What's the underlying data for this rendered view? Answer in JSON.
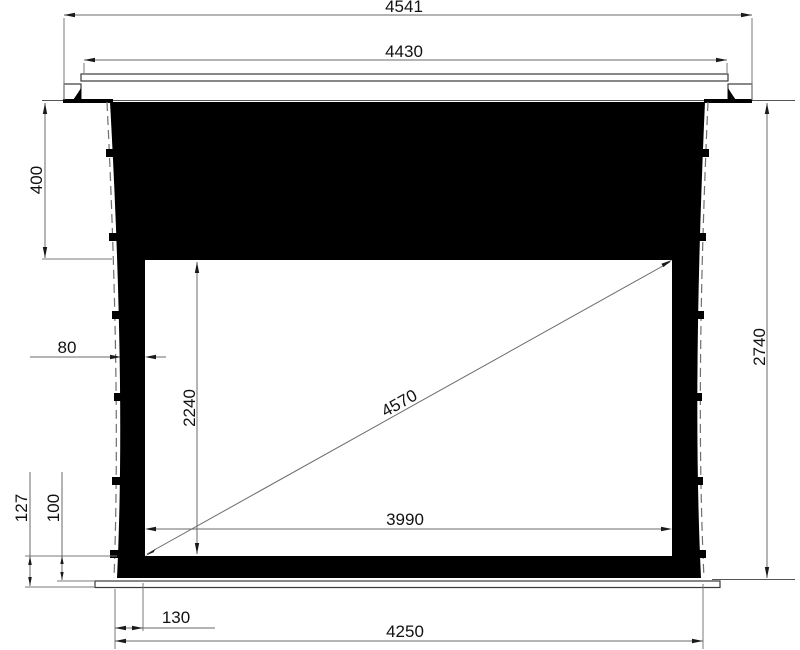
{
  "diagram": {
    "kind": "technical dimension drawing",
    "subject": "recessed tab-tensioned projection screen, front elevation",
    "screen_fill_color": "#000000",
    "viewing_area_color": "#ffffff",
    "line_color": "#6a6a6a",
    "text_color": "#111111"
  },
  "dims": {
    "overall_case_width": "4541",
    "flange_width": "4430",
    "top_black_drop": "400",
    "side_border_width": "80",
    "viewing_height": "2240",
    "diagonal": "4570",
    "viewing_width": "3990",
    "total_drop": "2740",
    "bottom_drop_total": "127",
    "bottom_border_height": "100",
    "bottom_corner_offset": "130",
    "bottom_bar_width": "4250"
  }
}
